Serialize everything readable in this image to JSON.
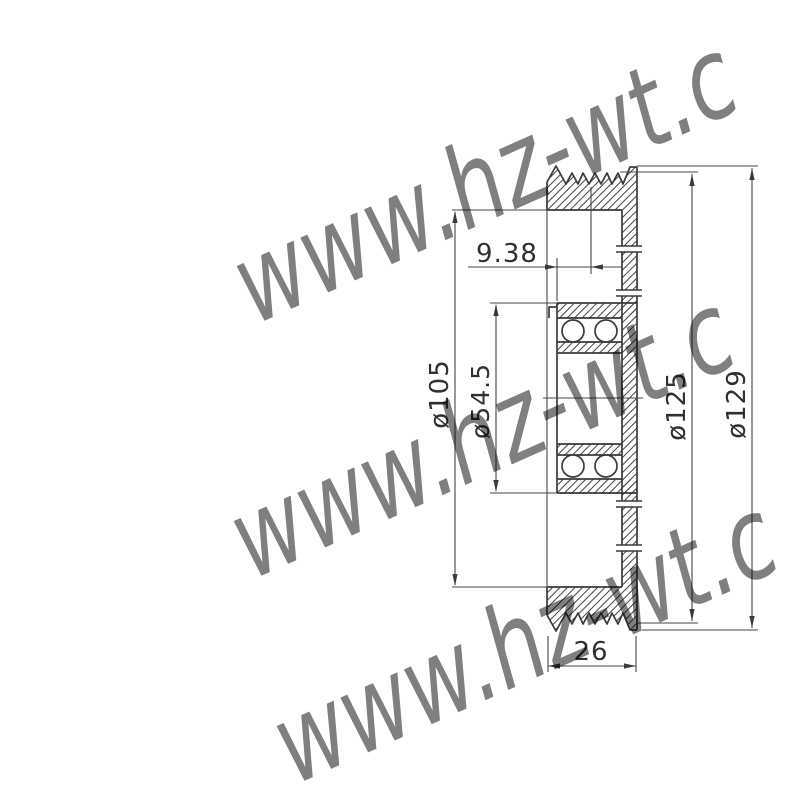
{
  "page": {
    "background_color": "#ffffff",
    "line_color": "#3a3a3a"
  },
  "watermark": {
    "text": "www.hz-wt.c",
    "color": "#8fede5",
    "instance_count": 3
  },
  "drawing": {
    "type": "pulley-bearing-cross-section",
    "dimensions": {
      "hub_offset": {
        "label": "9.38"
      },
      "rim_bore_diameter": {
        "label": "ø105"
      },
      "bearing_outer_diameter": {
        "label": "ø54.5"
      },
      "groove_diameter": {
        "label": "ø125"
      },
      "flange_diameter": {
        "label": "ø129"
      },
      "overall_width": {
        "label": "26"
      }
    }
  }
}
